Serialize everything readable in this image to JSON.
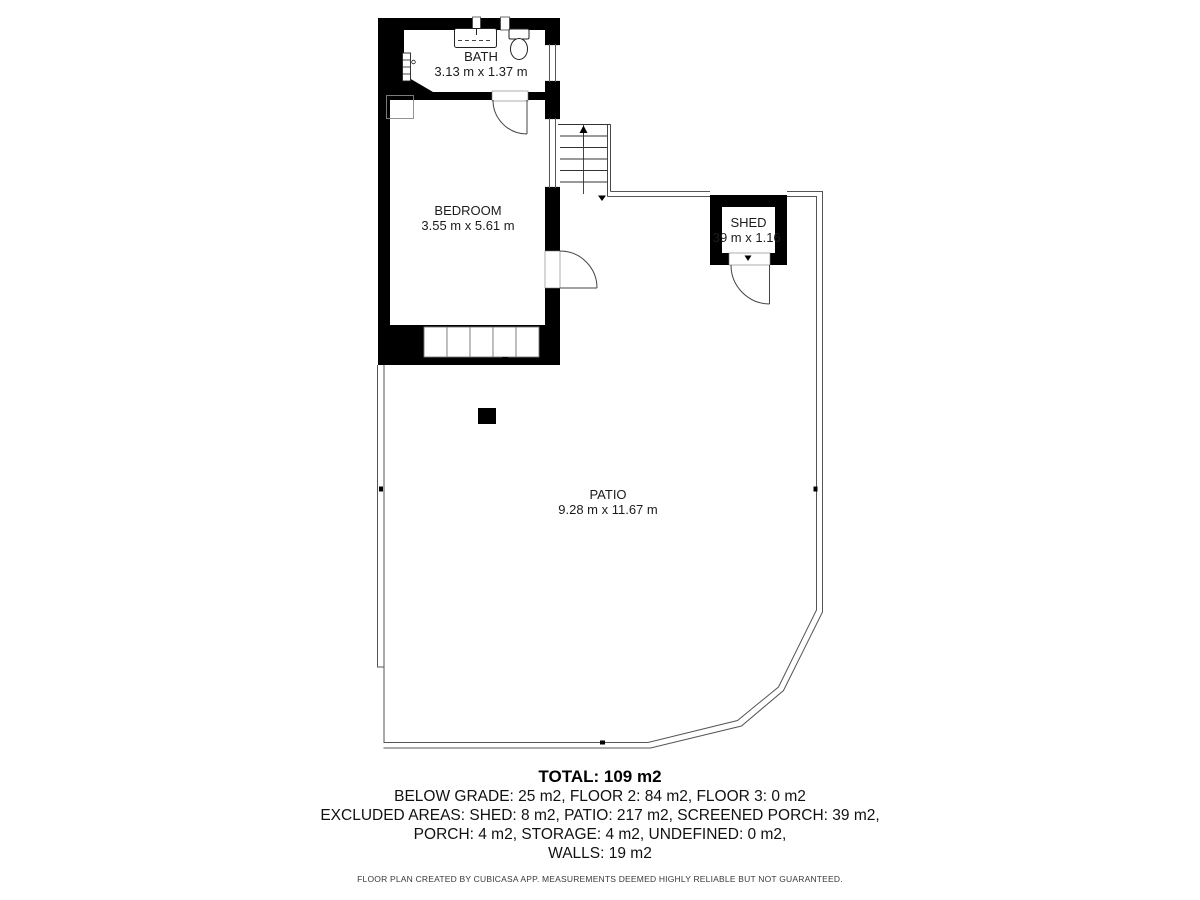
{
  "floorplan": {
    "rooms": {
      "bath": {
        "label": "BATH",
        "dimensions": "3.13 m x 1.37 m"
      },
      "bedroom": {
        "label": "BEDROOM",
        "dimensions": "3.55 m x 5.61 m"
      },
      "shed": {
        "label": "SHED",
        "dimensions": "1.39 m x 1.16 m"
      },
      "patio": {
        "label": "PATIO",
        "dimensions": "9.28 m x 11.67 m"
      }
    },
    "colors": {
      "wall": "#000000",
      "thin_line": "#555555",
      "fixture_line": "#333333",
      "text": "#1c1c1c",
      "background": "#ffffff"
    },
    "icons": [
      "sink-icon",
      "toilet-icon",
      "radiator-icon",
      "stairs-icon",
      "door-arc-icon",
      "window-icon"
    ]
  },
  "summary": {
    "total": "TOTAL: 109 m2",
    "line1": "BELOW GRADE: 25 m2, FLOOR 2: 84 m2, FLOOR 3: 0 m2",
    "line2": "EXCLUDED AREAS: SHED: 8 m2, PATIO: 217 m2, SCREENED PORCH: 39 m2,",
    "line3": "PORCH: 4 m2, STORAGE: 4 m2, UNDEFINED: 0 m2,",
    "line4": "WALLS: 19 m2"
  },
  "footer": {
    "disclaimer": "FLOOR PLAN CREATED BY CUBICASA APP. MEASUREMENTS DEEMED HIGHLY RELIABLE BUT NOT GUARANTEED."
  }
}
